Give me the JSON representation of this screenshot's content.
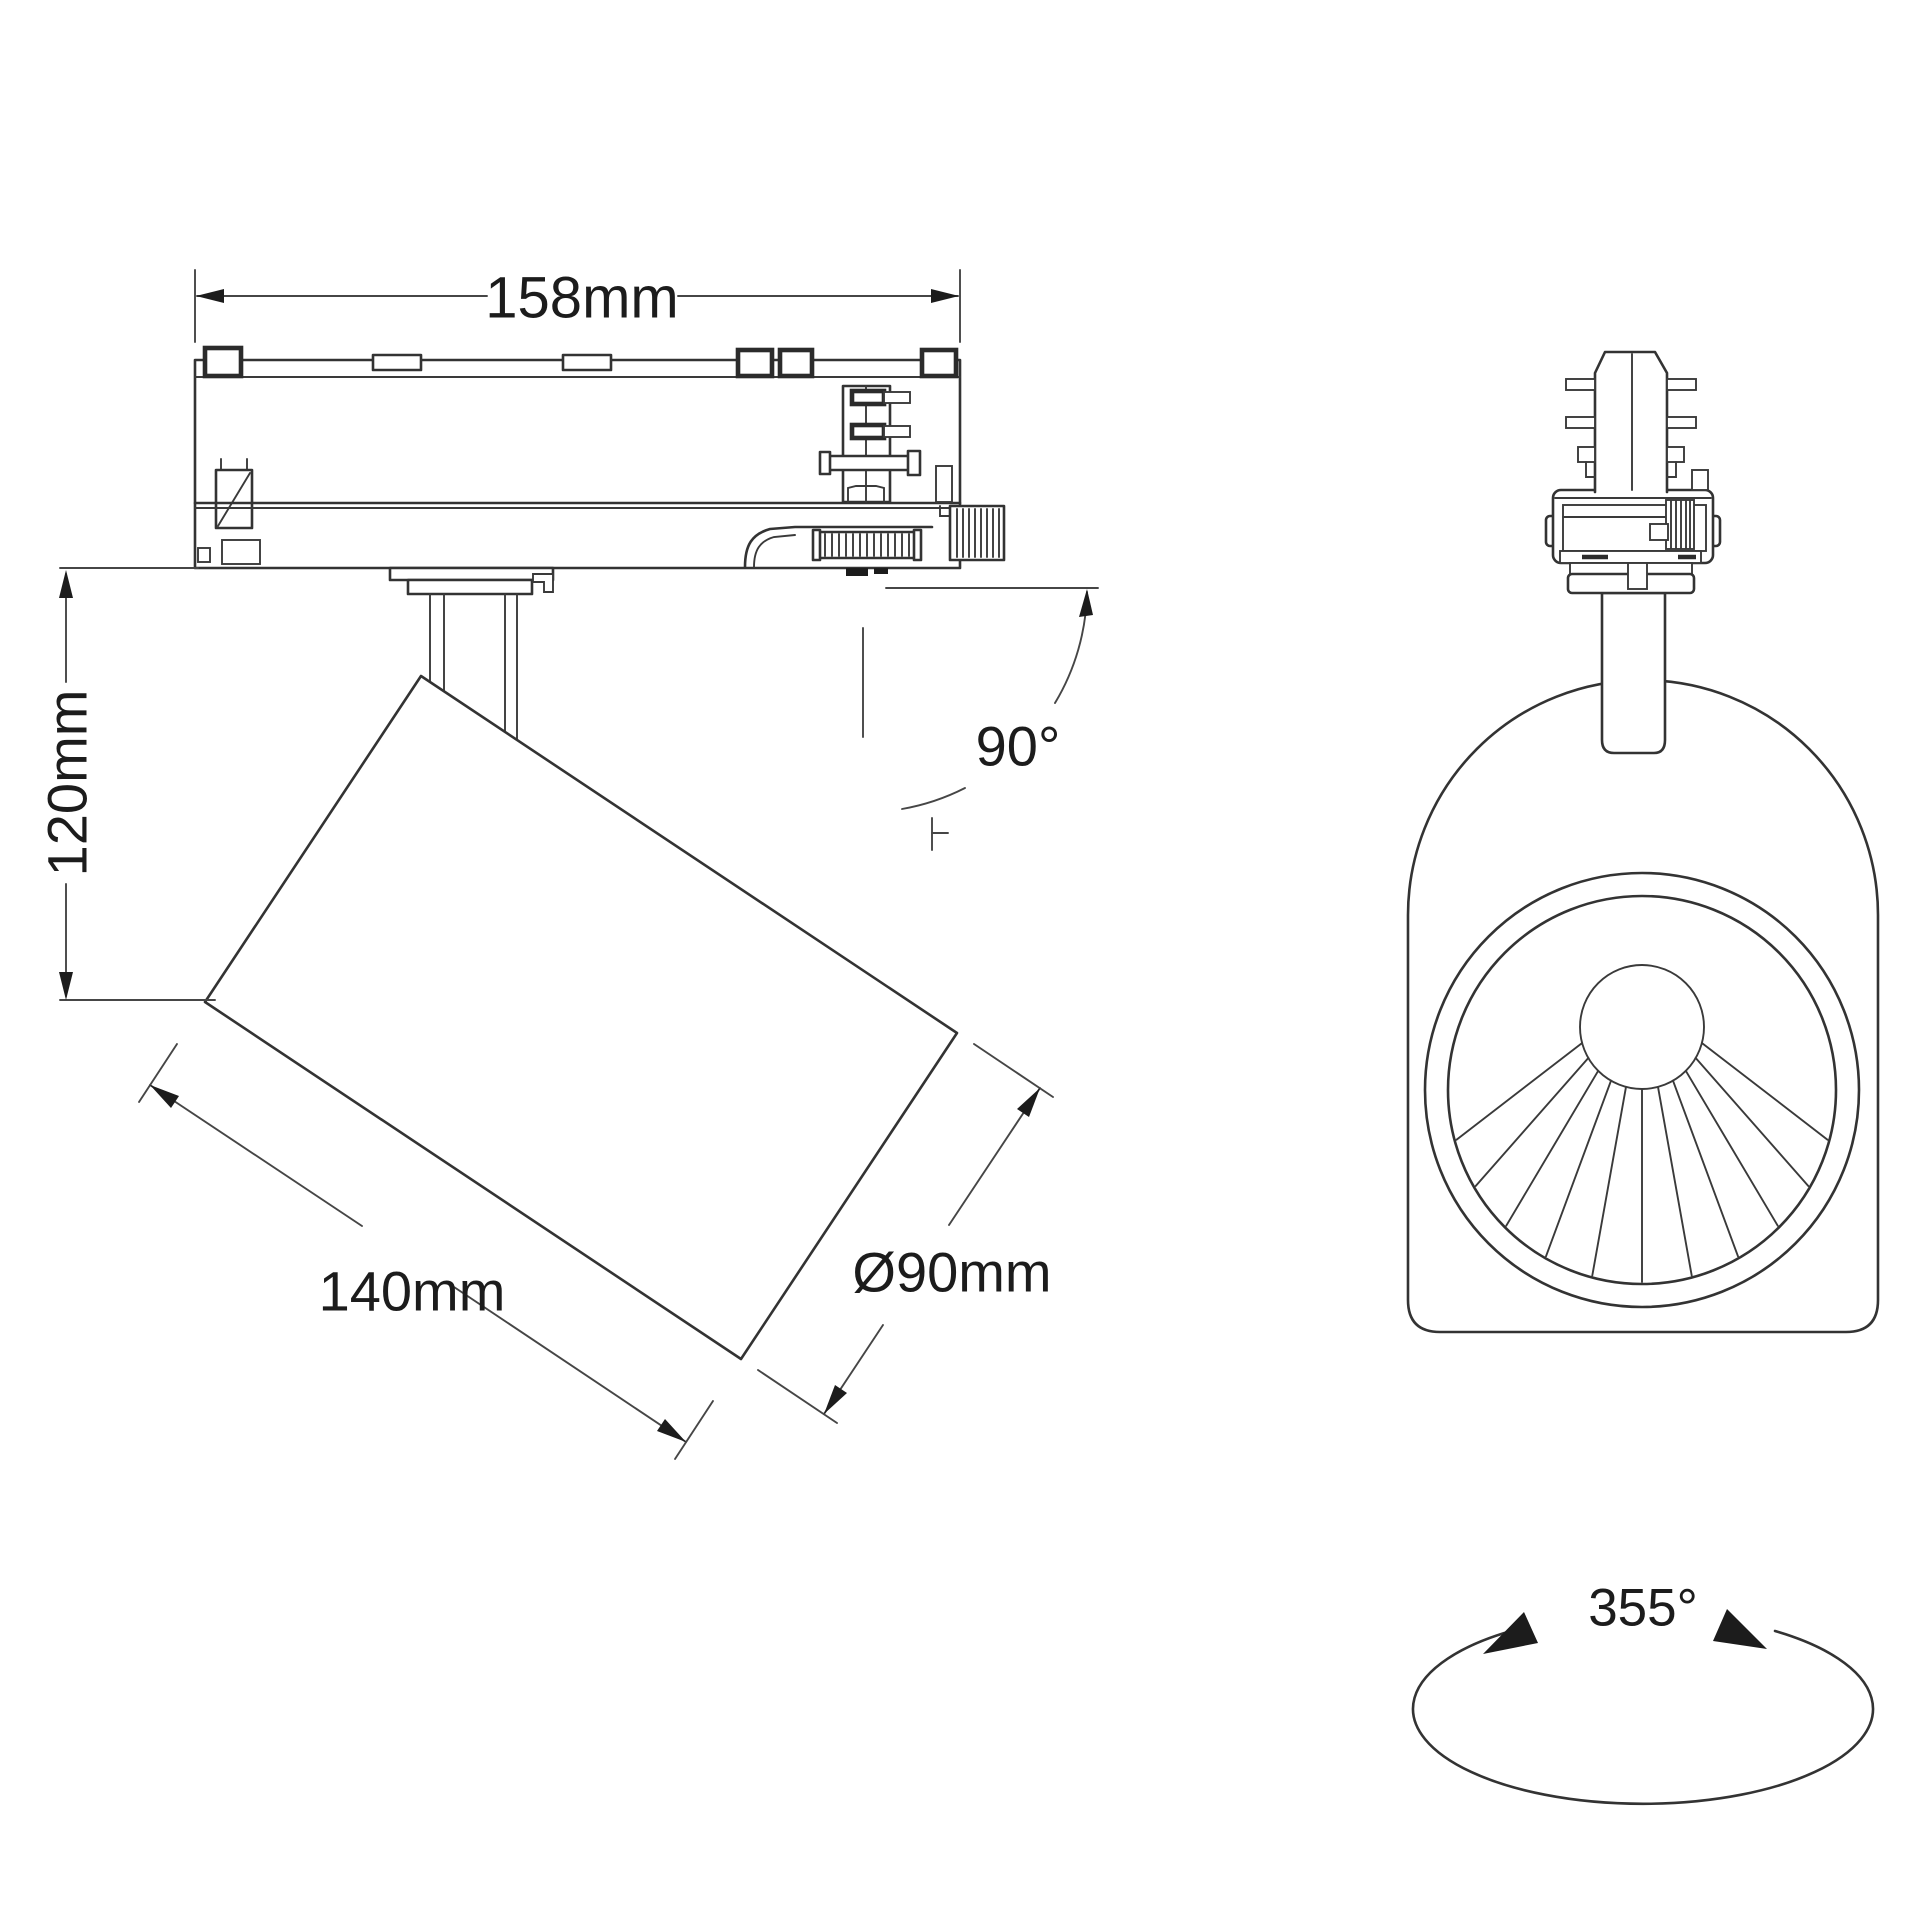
{
  "colors": {
    "line": "#333333",
    "dimension_line": "#464646",
    "text": "#1c1c1c",
    "background": "#ffffff"
  },
  "side_view": {
    "track_length_label": "158mm",
    "height_label": "120mm",
    "body_length_label": "140mm",
    "diameter_label": "Ø90mm",
    "tilt_angle_label": "90°"
  },
  "front_view": {
    "rotation_angle_label": "355°"
  }
}
